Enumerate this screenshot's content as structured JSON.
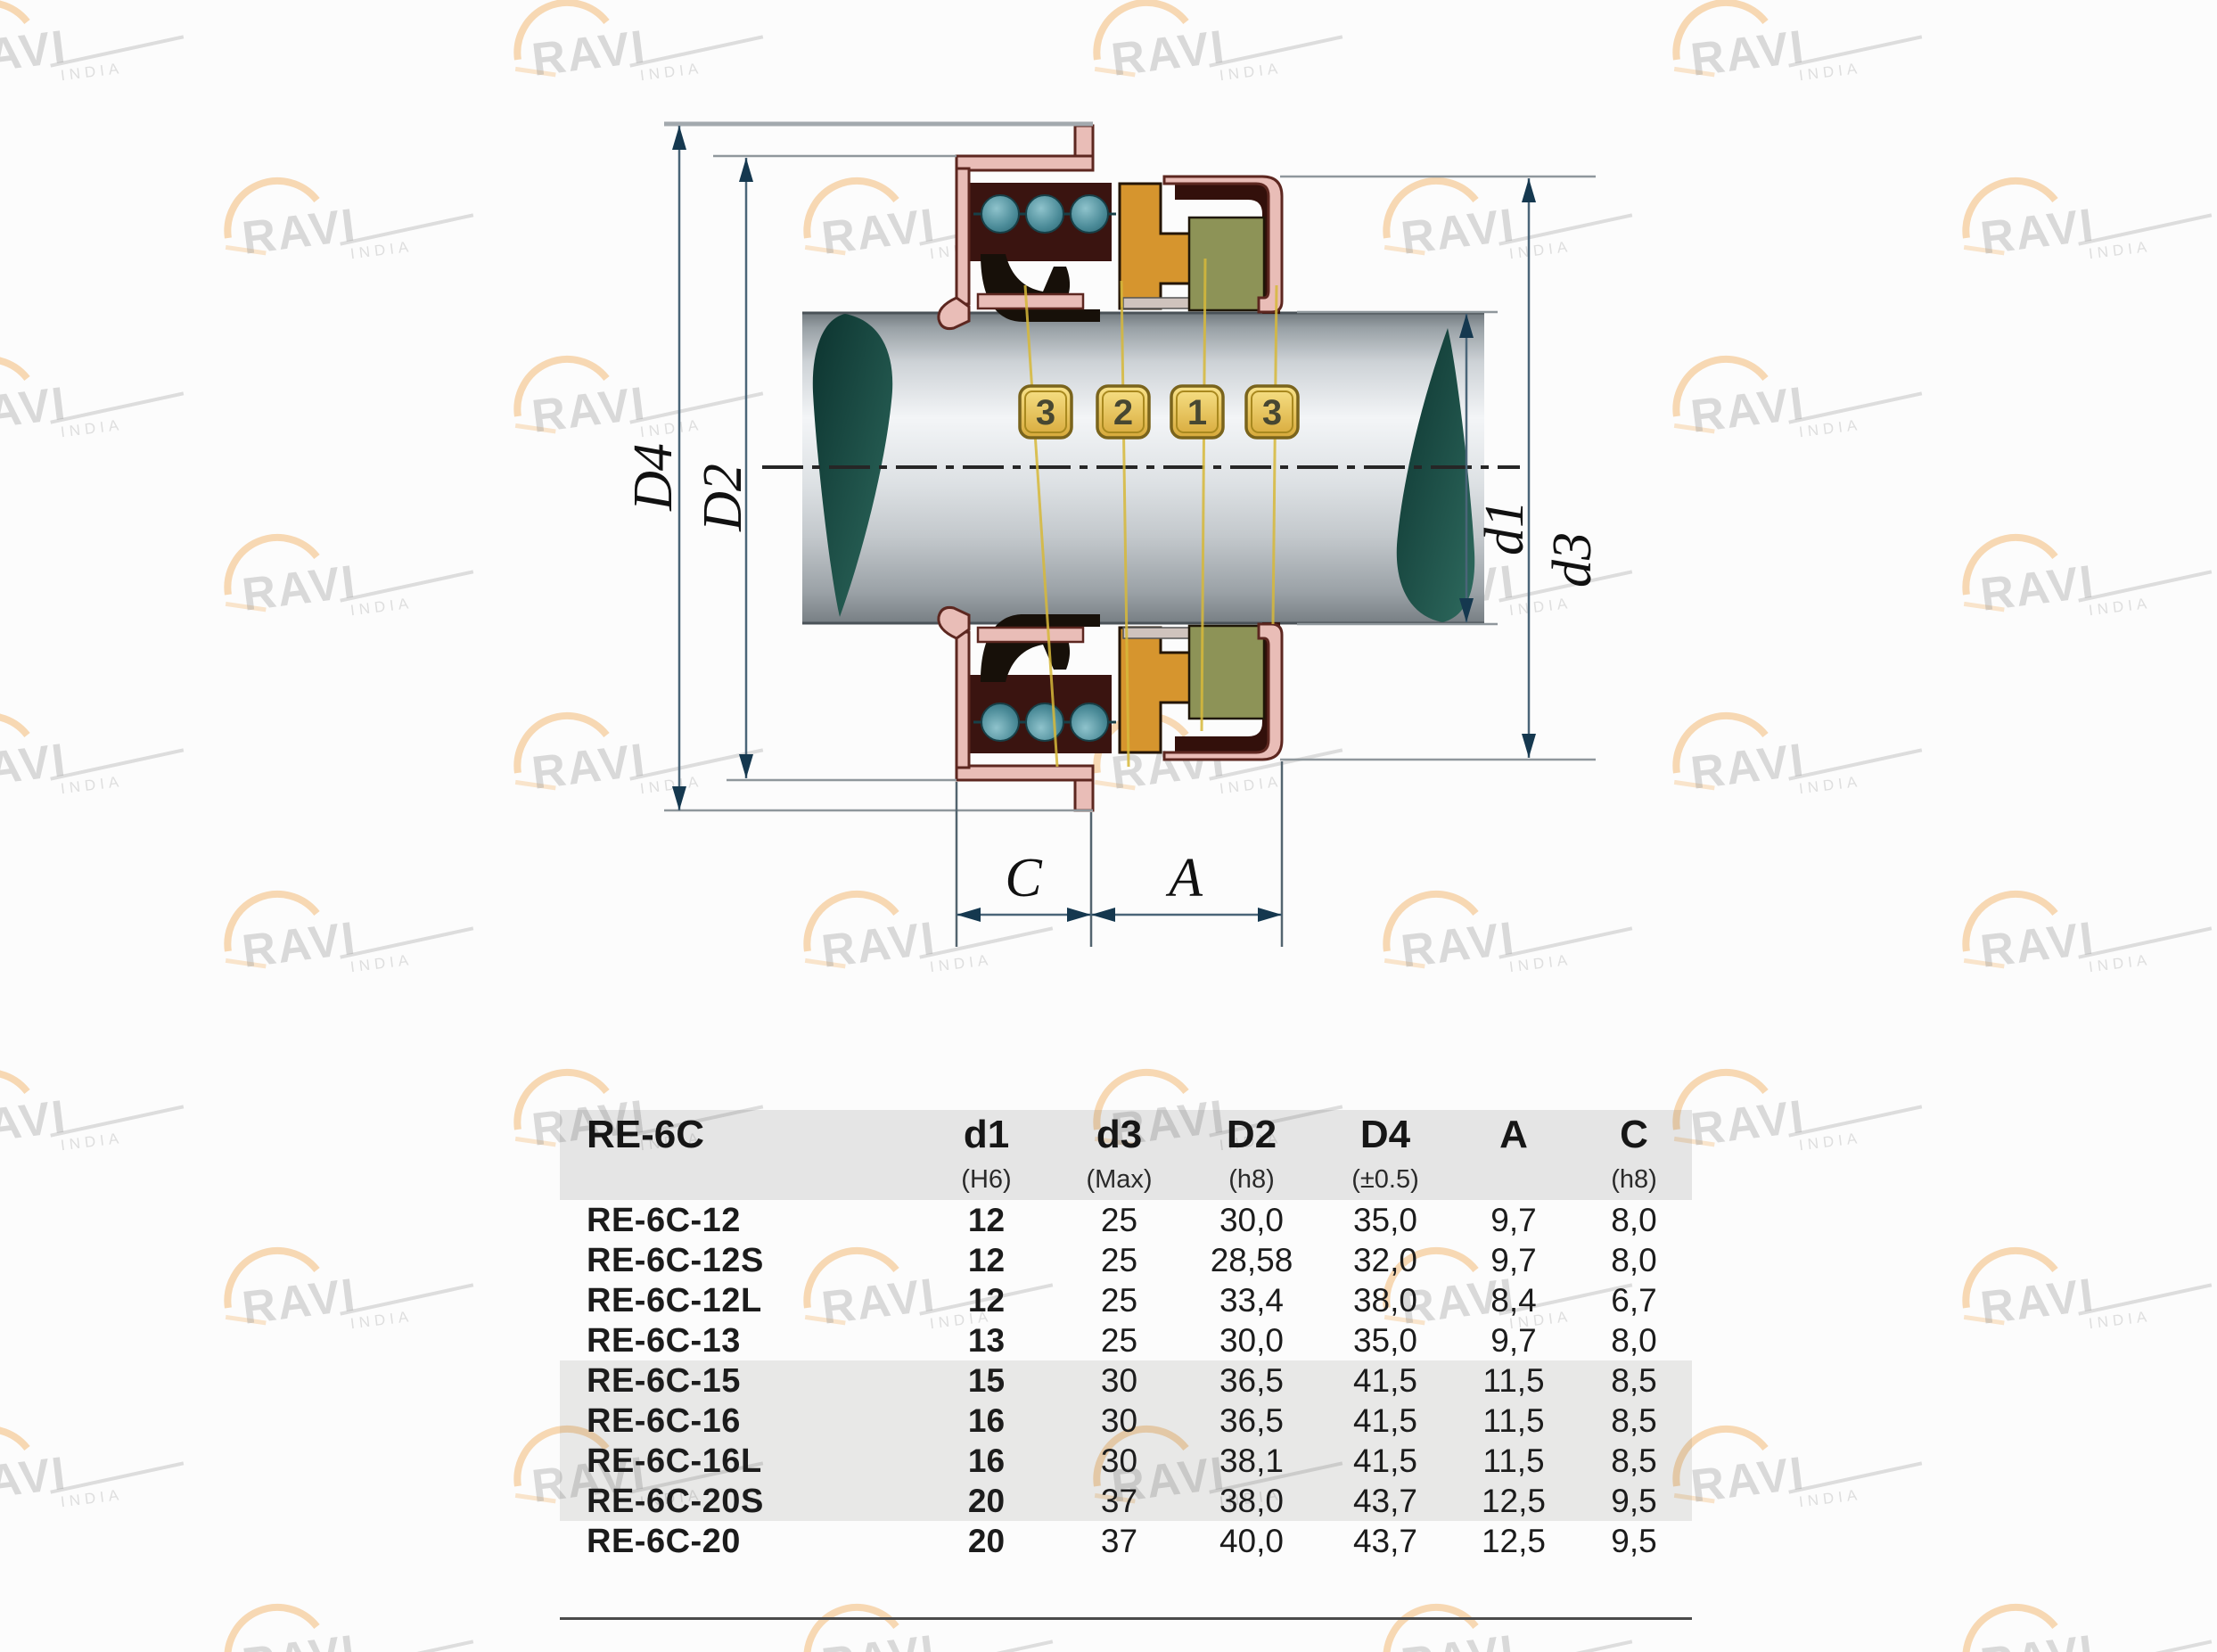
{
  "page": {
    "background": "#fcfcfc"
  },
  "watermark": {
    "brand": "RAVI",
    "sub": "INDIA"
  },
  "diagram": {
    "badges": [
      "3",
      "2",
      "1",
      "3"
    ],
    "dim_labels": {
      "D4": "D4",
      "D2": "D2",
      "d1": "d1",
      "d3": "d3",
      "C": "C",
      "A": "A"
    },
    "colors": {
      "gland_pink": "#e9bdb7",
      "outline_maroon": "#5d2720",
      "cavity_maroon": "#3a1410",
      "spring_teal": "#4f93a0",
      "bellows_black": "#171009",
      "ring_orange": "#d6952e",
      "seat_green": "#8d9357",
      "seat_cup_maroon": "#33100b",
      "leader_yellow": "#d7b93a",
      "badge_gold": "#ecc95d",
      "shaft_light": "#f3f5f7",
      "shaft_dark": "#767e83",
      "break_teal": "#16443c",
      "dim_line": "#4a6578",
      "arrow_navy": "#15384f"
    }
  },
  "table": {
    "title": "RE-6C",
    "columns": [
      {
        "label": "d1",
        "sub": "(H6)"
      },
      {
        "label": "d3",
        "sub": "(Max)"
      },
      {
        "label": "D2",
        "sub": "(h8)"
      },
      {
        "label": "D4",
        "sub": "(±0.5)"
      },
      {
        "label": "A",
        "sub": ""
      },
      {
        "label": "C",
        "sub": "(h8)"
      }
    ],
    "rows": [
      {
        "model": "RE-6C-12",
        "d1": "12",
        "d3": "25",
        "D2": "30,0",
        "D4": "35,0",
        "A": "9,7",
        "C": "8,0"
      },
      {
        "model": "RE-6C-12S",
        "d1": "12",
        "d3": "25",
        "D2": "28,58",
        "D4": "32,0",
        "A": "9,7",
        "C": "8,0"
      },
      {
        "model": "RE-6C-12L",
        "d1": "12",
        "d3": "25",
        "D2": "33,4",
        "D4": "38,0",
        "A": "8,4",
        "C": "6,7"
      },
      {
        "model": "RE-6C-13",
        "d1": "13",
        "d3": "25",
        "D2": "30,0",
        "D4": "35,0",
        "A": "9,7",
        "C": "8,0"
      },
      {
        "model": "RE-6C-15",
        "d1": "15",
        "d3": "30",
        "D2": "36,5",
        "D4": "41,5",
        "A": "11,5",
        "C": "8,5"
      },
      {
        "model": "RE-6C-16",
        "d1": "16",
        "d3": "30",
        "D2": "36,5",
        "D4": "41,5",
        "A": "11,5",
        "C": "8,5"
      },
      {
        "model": "RE-6C-16L",
        "d1": "16",
        "d3": "30",
        "D2": "38,1",
        "D4": "41,5",
        "A": "11,5",
        "C": "8,5"
      },
      {
        "model": "RE-6C-20S",
        "d1": "20",
        "d3": "37",
        "D2": "38,0",
        "D4": "43,7",
        "A": "12,5",
        "C": "9,5"
      },
      {
        "model": "RE-6C-20",
        "d1": "20",
        "d3": "37",
        "D2": "40,0",
        "D4": "43,7",
        "A": "12,5",
        "C": "9,5"
      }
    ]
  }
}
